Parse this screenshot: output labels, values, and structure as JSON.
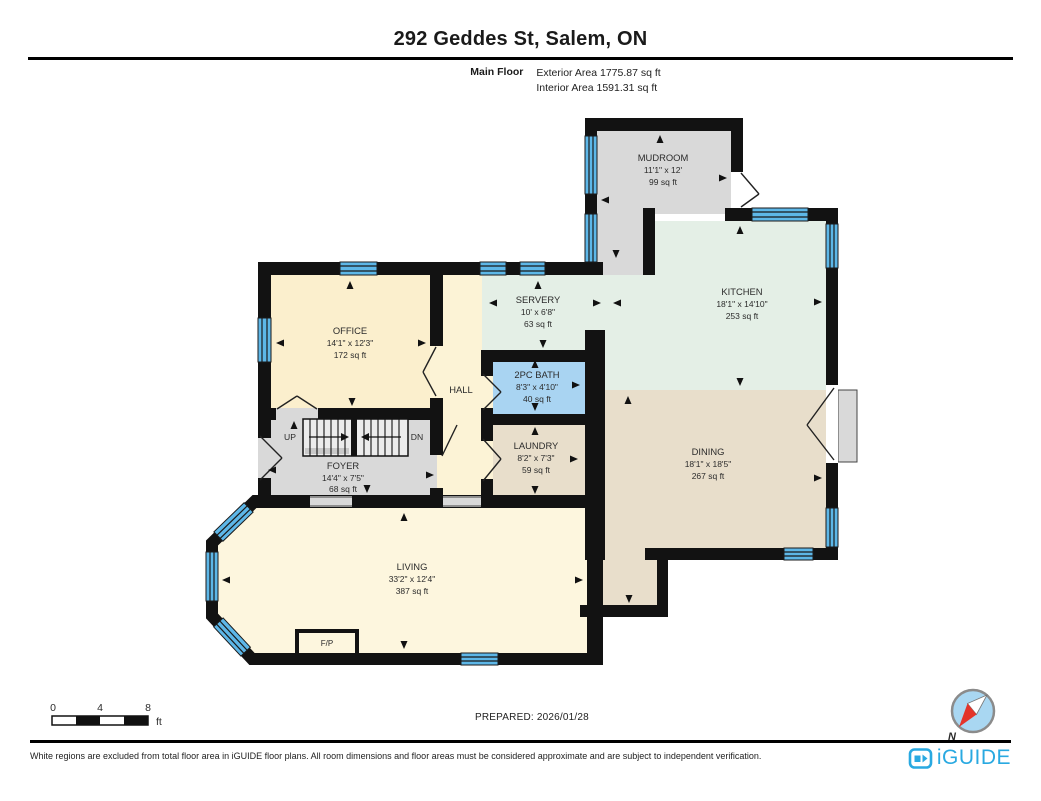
{
  "header": {
    "title": "292 Geddes St, Salem, ON",
    "floor_label": "Main Floor",
    "exterior_area": "Exterior Area 1775.87 sq ft",
    "interior_area": "Interior Area 1591.31 sq ft"
  },
  "rooms": {
    "mudroom": {
      "name": "MUDROOM",
      "dims": "11'1\" x 12'",
      "area": "99 sq ft"
    },
    "kitchen": {
      "name": "KITCHEN",
      "dims": "18'1\" x 14'10\"",
      "area": "253 sq ft"
    },
    "servery": {
      "name": "SERVERY",
      "dims": "10' x 6'8\"",
      "area": "63 sq ft"
    },
    "office": {
      "name": "OFFICE",
      "dims": "14'1\" x 12'3\"",
      "area": "172 sq ft"
    },
    "hall": {
      "name": "HALL"
    },
    "bath": {
      "name": "2PC BATH",
      "dims": "8'3\" x 4'10\"",
      "area": "40 sq ft"
    },
    "laundry": {
      "name": "LAUNDRY",
      "dims": "8'2\" x 7'3\"",
      "area": "59 sq ft"
    },
    "dining": {
      "name": "DINING",
      "dims": "18'1\" x 18'5\"",
      "area": "267 sq ft"
    },
    "foyer": {
      "name": "FOYER",
      "dims": "14'4\" x 7'5\"",
      "area": "68 sq ft"
    },
    "living": {
      "name": "LIVING",
      "dims": "33'2\" x 12'4\"",
      "area": "387 sq ft"
    }
  },
  "plan_labels": {
    "up": "UP",
    "down": "DN",
    "fireplace": "F/P",
    "north": "N"
  },
  "scale_bar": {
    "tick_0": "0",
    "tick_4": "4",
    "tick_8": "8",
    "unit": "ft"
  },
  "footer": {
    "prepared": "PREPARED: 2026/01/28",
    "disclaimer": "White regions are excluded from total floor area in iGUIDE floor plans. All room dimensions and floor areas must be considered approximate and are subject to independent verification.",
    "brand": "iGUIDE"
  },
  "colors": {
    "wall": "#121212",
    "window": "#5db7e8",
    "room_gray": "#d9d9d9",
    "room_mint": "#e4efe6",
    "room_cream": "#fdf6de",
    "room_office": "#fbefcd",
    "room_blue": "#a9d4f2",
    "room_tan": "#e8decb",
    "brand_blue": "#29a9e1",
    "compass_red": "#e3342a"
  }
}
